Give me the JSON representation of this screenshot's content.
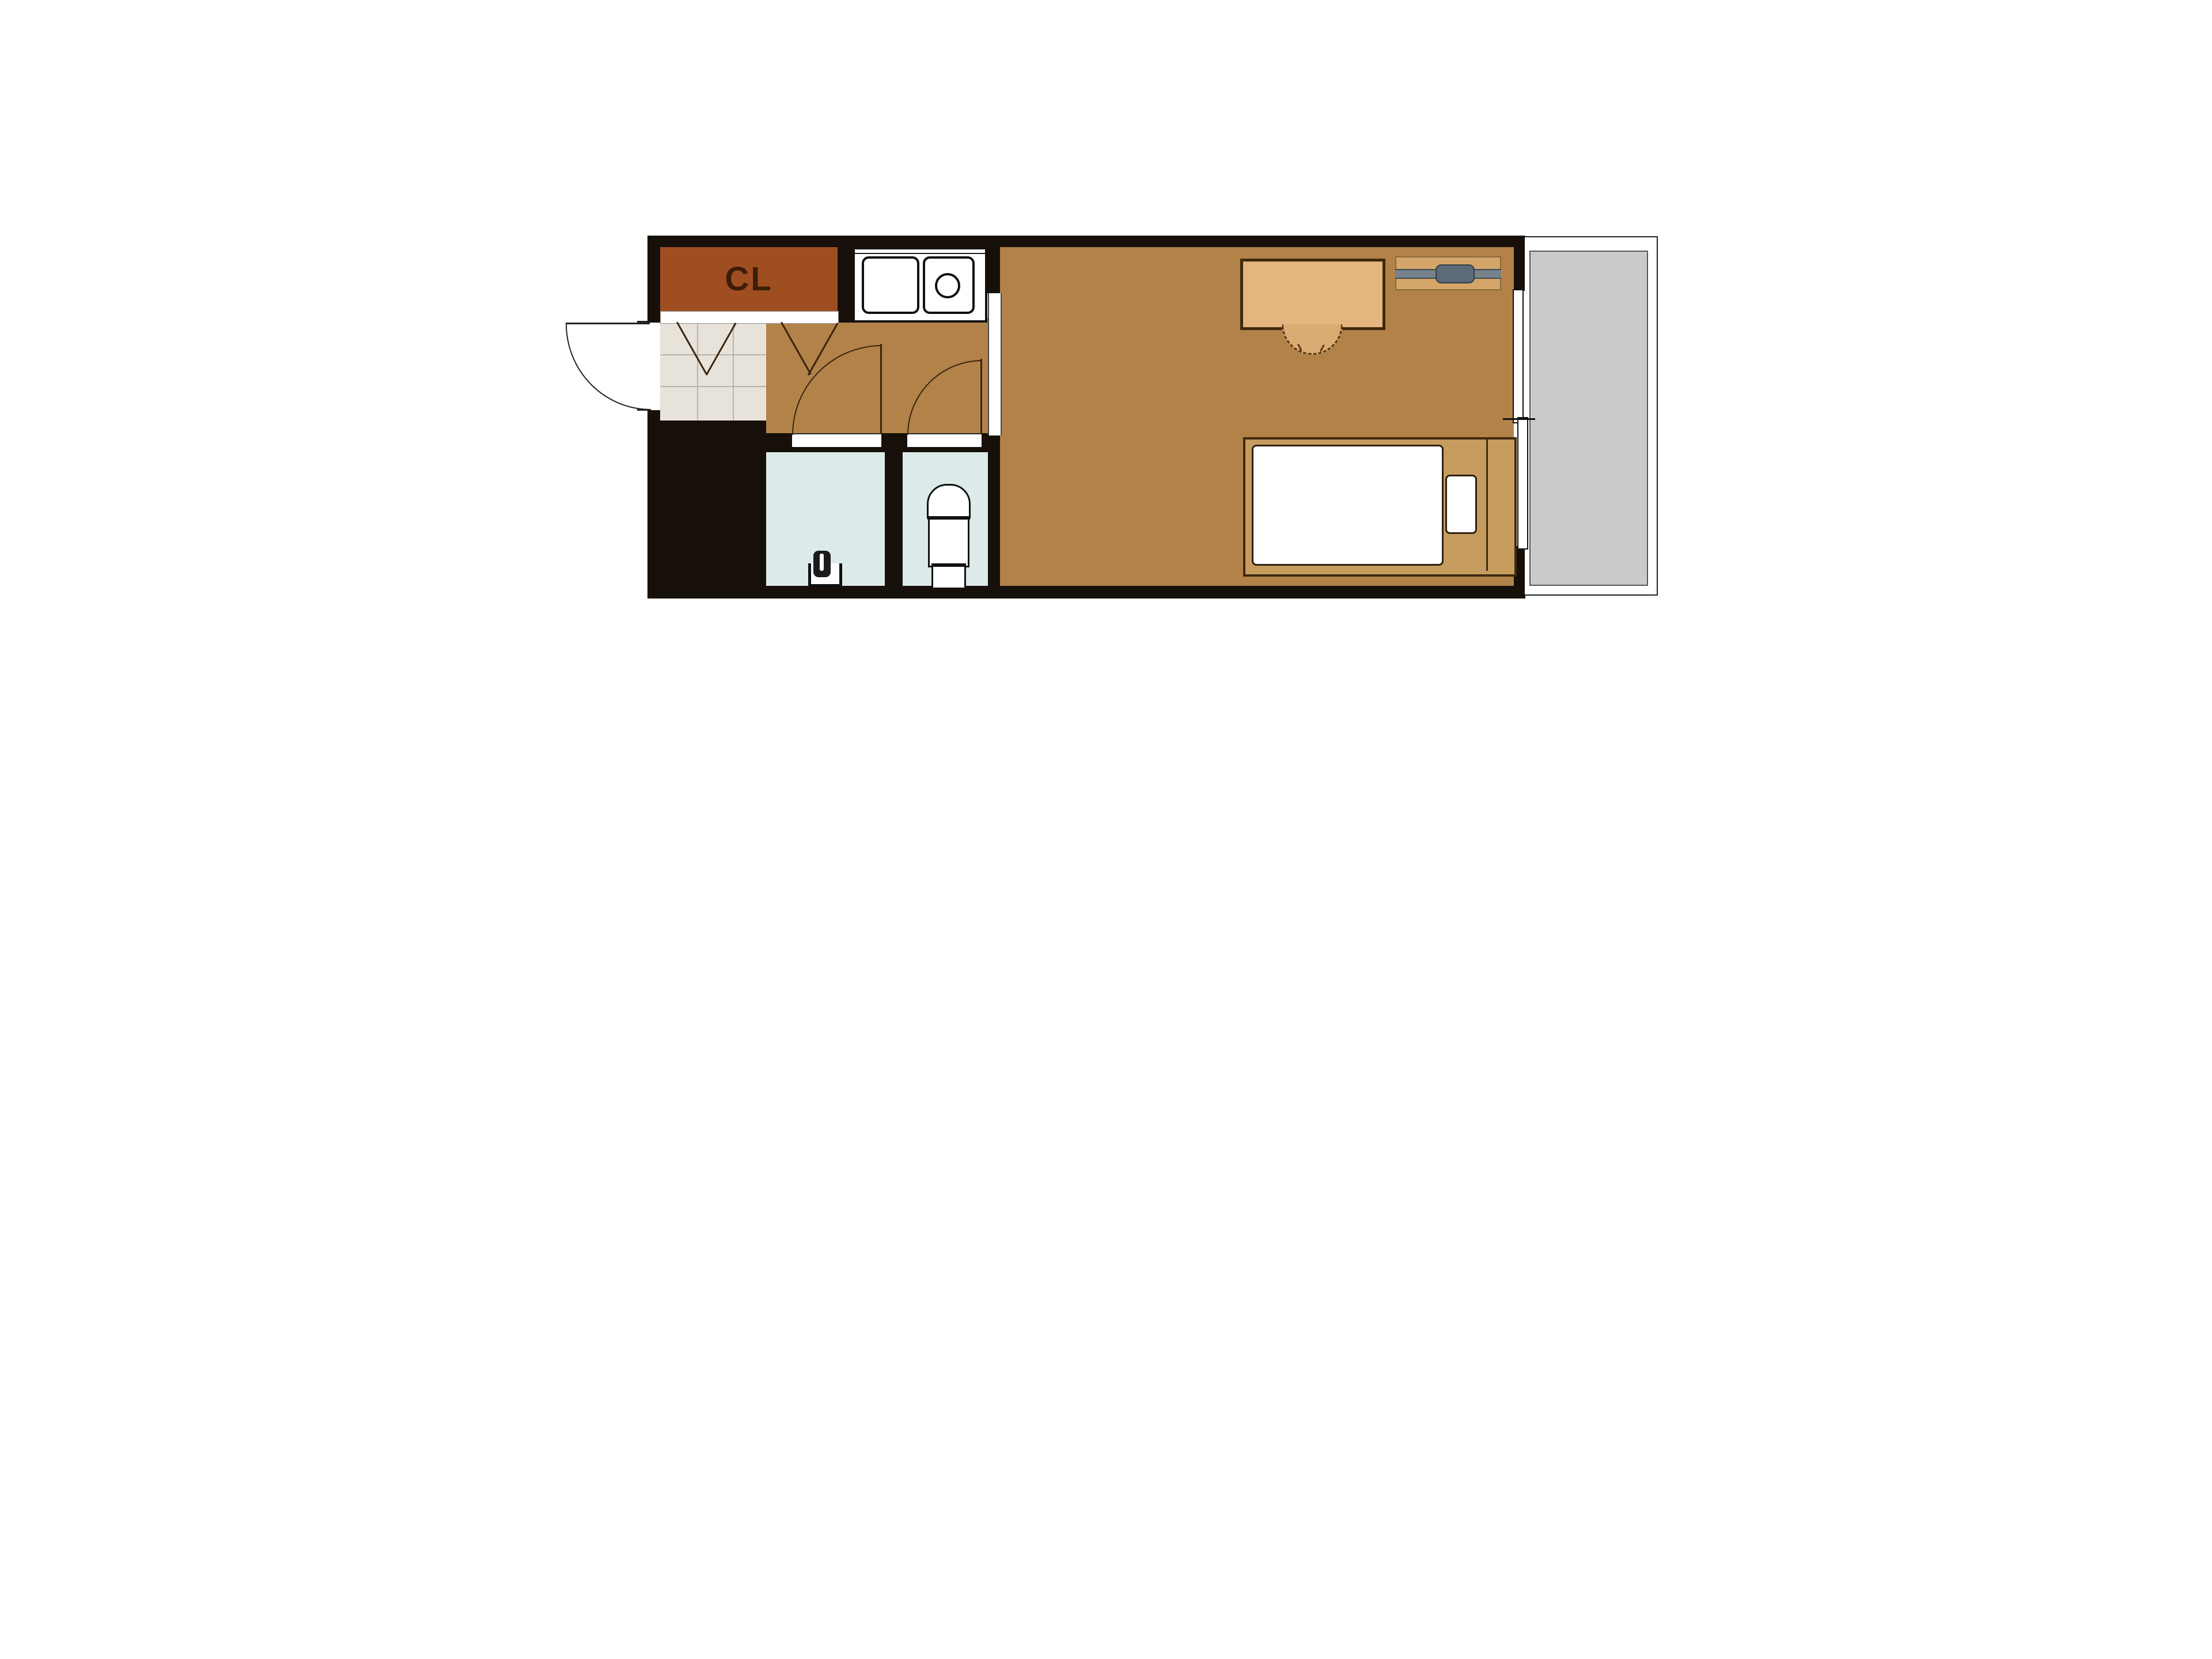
{
  "labels": {
    "closet": "CL"
  },
  "colors": {
    "wall": "#17100a",
    "floor": "#b28249",
    "closet_fill": "#9f4e22",
    "closet_text": "#3c1d08",
    "tile": "#e7e3da",
    "tile_grid": "#b8b4a9",
    "wet_room": "#dcebea",
    "balcony": "#cacaca",
    "furniture_outline": "#42280c",
    "desk_fill": "#e2b67e",
    "chair_fill": "#d9ac73",
    "bed_frame_fill": "#c79c5f",
    "ac_fill": "#d4a569",
    "ac_bar": "#76838b",
    "ac_capsule": "#5c6b77",
    "door_line": "#3a2410",
    "line": "#222222"
  },
  "symbols": [
    "entrance-door",
    "closet",
    "closet-sliding-doors",
    "kitchen-sink-counter",
    "bathroom-door",
    "toilet-door",
    "toilet",
    "faucet-fixture",
    "desk",
    "chair",
    "air-conditioner",
    "bed",
    "mattress",
    "pillow",
    "sliding-glass-door",
    "balcony"
  ]
}
